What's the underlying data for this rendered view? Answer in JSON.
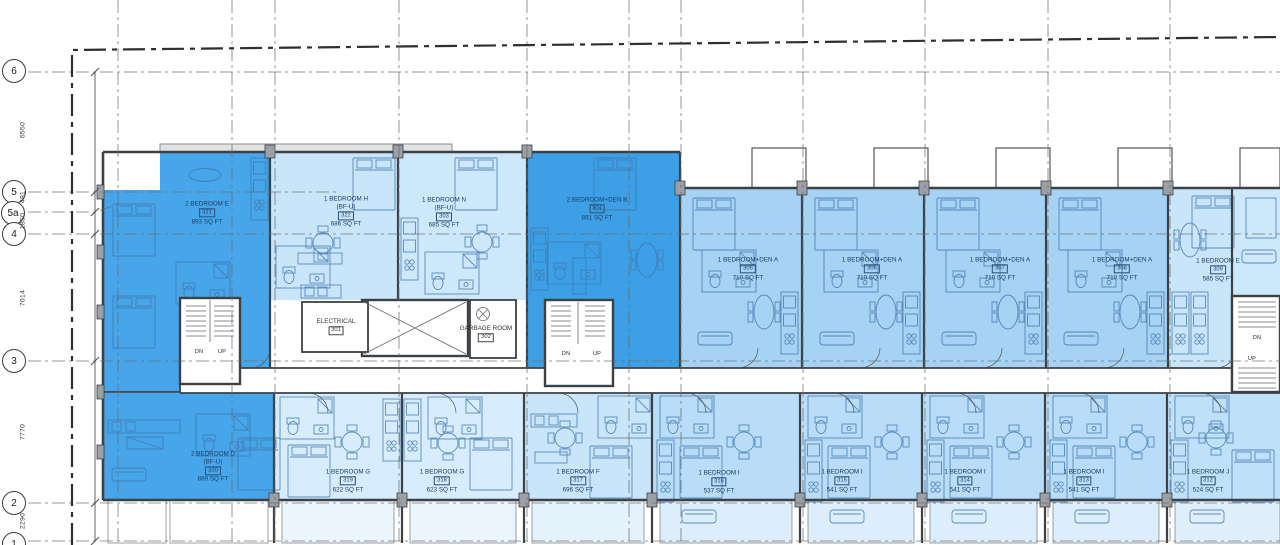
{
  "drawing": {
    "type": "residential floor plan",
    "corridor_levels": "double-loaded corridor, two unit rows"
  },
  "colors": {
    "unit_dark_blue": "#47a6ea",
    "unit_medium_blue": "#a6d3f4",
    "unit_light_blue": "#c9e5fa",
    "unit_pale_blue": "#d7ecfd",
    "wall": "#3c4146",
    "gridline": "#6b6b6b"
  },
  "grid": {
    "rows": [
      {
        "label": "6"
      },
      {
        "label": "5"
      },
      {
        "label": "5a"
      },
      {
        "label": "4"
      },
      {
        "label": "3"
      },
      {
        "label": "2"
      },
      {
        "label": "1"
      }
    ],
    "dimensions": [
      {
        "value": "6550"
      },
      {
        "value": "481"
      },
      {
        "value": "1850"
      },
      {
        "value": "7014"
      },
      {
        "value": "7770"
      },
      {
        "value": "2290"
      }
    ]
  },
  "rooms": {
    "electrical": {
      "name": "ELECTRICAL",
      "number": "301"
    },
    "garbage": {
      "name": "GARBAGE ROOM",
      "number": "302"
    }
  },
  "stairs": {
    "down": "DN",
    "up": "UP"
  },
  "units": [
    {
      "name": "2 BEDROOM E",
      "number": "321",
      "area": "893 SQ FT"
    },
    {
      "name": "1 BEDROOM H",
      "bf": "(BF-U)",
      "number": "322",
      "area": "686 SQ FT"
    },
    {
      "name": "1 BEDROOM N",
      "bf": "(BF-U)",
      "number": "303",
      "area": "685 SQ FT"
    },
    {
      "name": "2 BEDROOM+DEN B",
      "number": "304",
      "area": "891 SQ FT"
    },
    {
      "name": "1 BEDROOM+DEN A",
      "number": "305",
      "area": "710 SQ FT"
    },
    {
      "name": "1 BEDROOM+DEN A",
      "number": "306",
      "area": "710 SQ FT"
    },
    {
      "name": "1 BEDROOM+DEN A",
      "number": "307",
      "area": "710 SQ FT"
    },
    {
      "name": "1 BEDROOM+DEN A",
      "number": "308",
      "area": "710 SQ FT"
    },
    {
      "name": "1 BEDROOM E",
      "number": "309",
      "area": "585 SQ FT"
    },
    {
      "name": "2 BEDROOM D",
      "bf": "(BF-U)",
      "number": "320",
      "area": "889 SQ FT"
    },
    {
      "name": "1 BEDROOM G",
      "number": "319",
      "area": "622 SQ FT"
    },
    {
      "name": "1 BEDROOM G",
      "number": "318",
      "area": "623 SQ FT"
    },
    {
      "name": "1 BEDROOM F",
      "number": "317",
      "area": "696 SQ FT"
    },
    {
      "name": "1 BEDROOM I",
      "number": "316",
      "area": "537 SQ FT"
    },
    {
      "name": "1 BEDROOM I",
      "number": "315",
      "area": "541 SQ FT"
    },
    {
      "name": "1 BEDROOM I",
      "number": "314",
      "area": "541 SQ FT"
    },
    {
      "name": "1 BEDROOM I",
      "number": "313",
      "area": "541 SQ FT"
    },
    {
      "name": "1 BEDROOM J",
      "number": "312",
      "area": "524 SQ FT"
    }
  ]
}
